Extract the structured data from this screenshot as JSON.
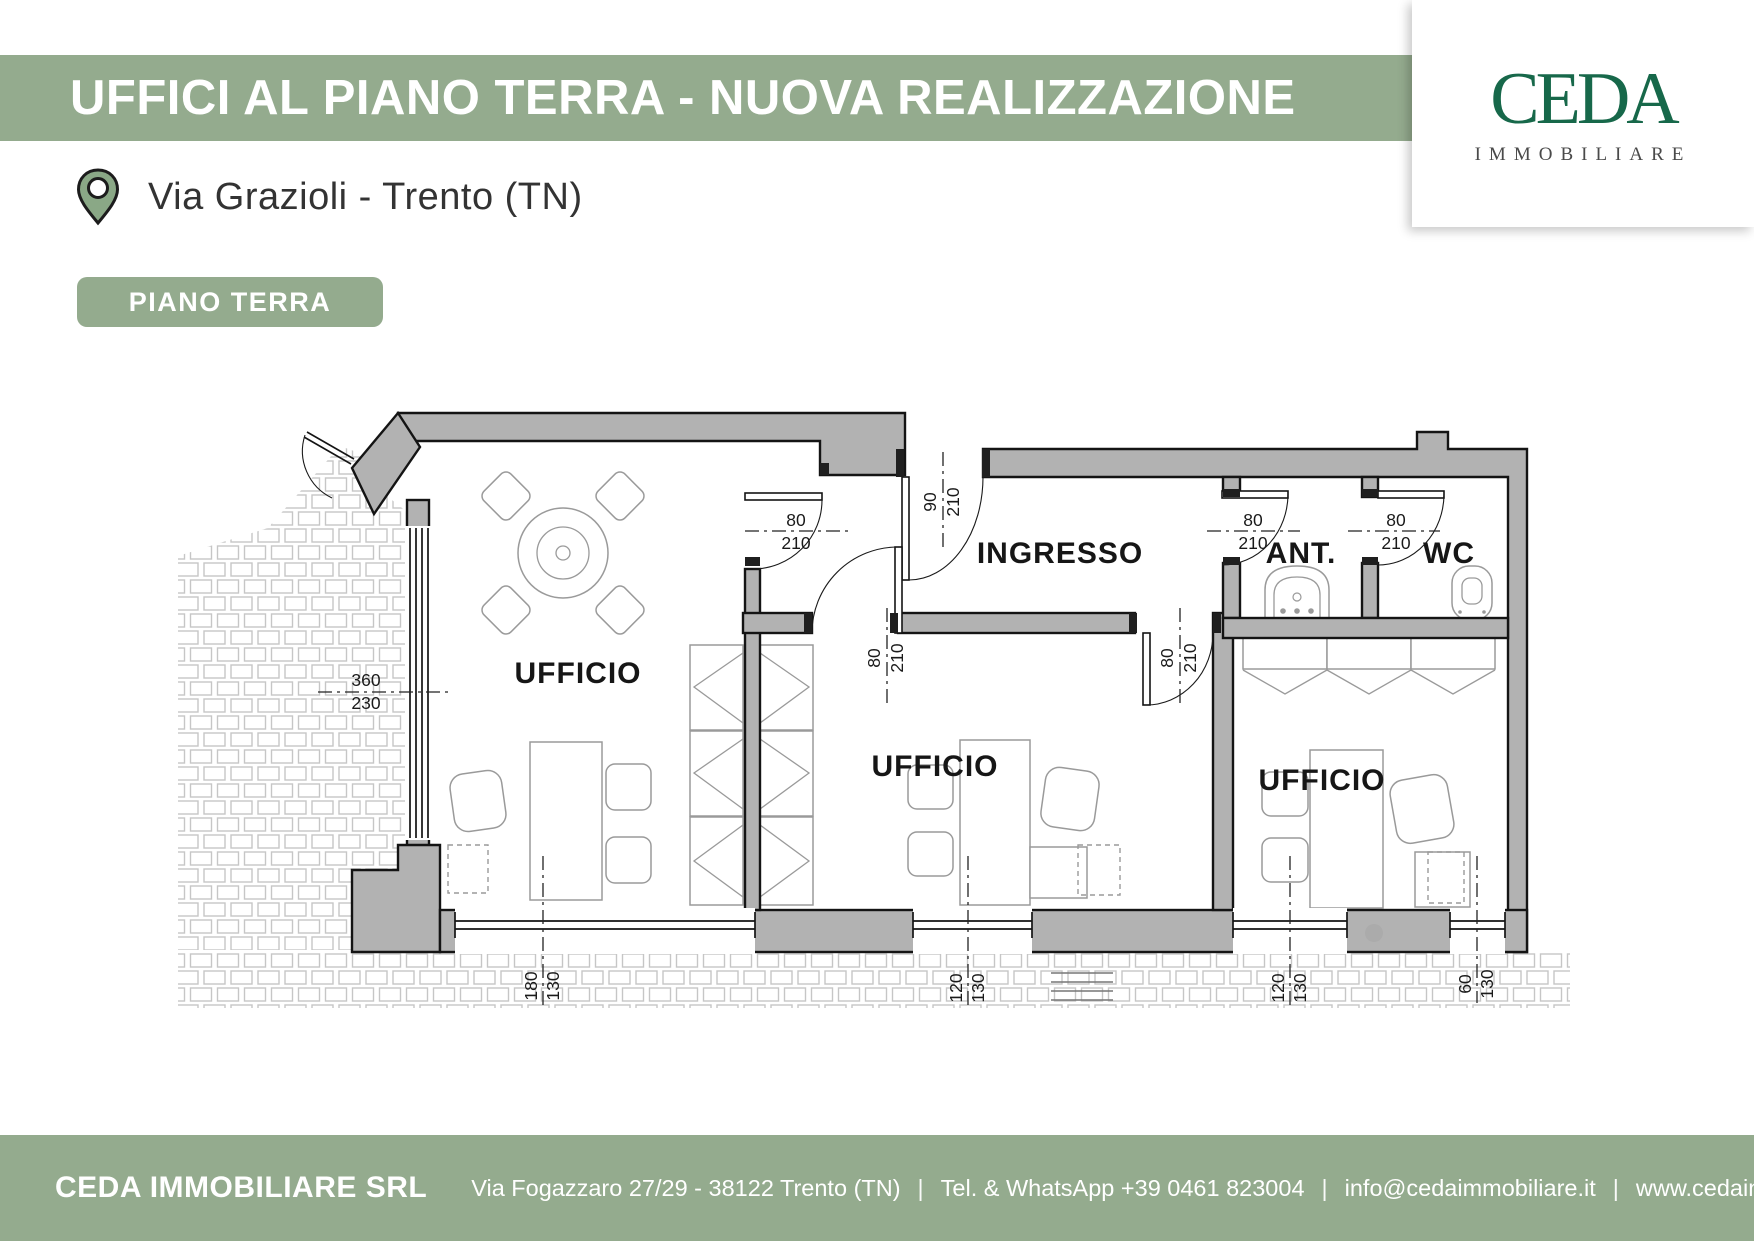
{
  "header": {
    "title": "UFFICI AL PIANO TERRA - NUOVA REALIZZAZIONE",
    "location": "Via Grazioli - Trento (TN)",
    "floor_badge": "PIANO TERRA"
  },
  "logo": {
    "name": "CEDA",
    "subtitle": "IMMOBILIARE"
  },
  "colors": {
    "banner_green": "#94ab8e",
    "logo_green": "#17684a",
    "wall_gray": "#b2b2b2"
  },
  "plan": {
    "rooms": {
      "office1": "UFFICIO",
      "office2": "UFFICIO",
      "office3": "UFFICIO",
      "hall": "INGRESSO",
      "ante": "ANT.",
      "wc": "WC"
    },
    "dims": {
      "left_window": {
        "w": "360",
        "h": "230"
      },
      "door_office1": {
        "w": "80",
        "h": "210"
      },
      "door_entrance": {
        "w": "90",
        "h": "210"
      },
      "door_office2": {
        "w": "80",
        "h": "210"
      },
      "door_office3": {
        "w": "80",
        "h": "210"
      },
      "door_ant": {
        "w": "80",
        "h": "210"
      },
      "door_wc": {
        "w": "80",
        "h": "210"
      },
      "window1": {
        "w": "180",
        "h": "130"
      },
      "window2": {
        "w": "120",
        "h": "130"
      },
      "window3": {
        "w": "120",
        "h": "130"
      },
      "window4": {
        "w": "60",
        "h": "130"
      }
    }
  },
  "footer": {
    "company": "CEDA IMMOBILIARE SRL",
    "address": "Via Fogazzaro 27/29 - 38122 Trento (TN)",
    "phone": "Tel. & WhatsApp +39 0461 823004",
    "email": "info@cedaimmobiliare.it",
    "website": "www.cedaimmobiliare.it",
    "separator": "|"
  }
}
